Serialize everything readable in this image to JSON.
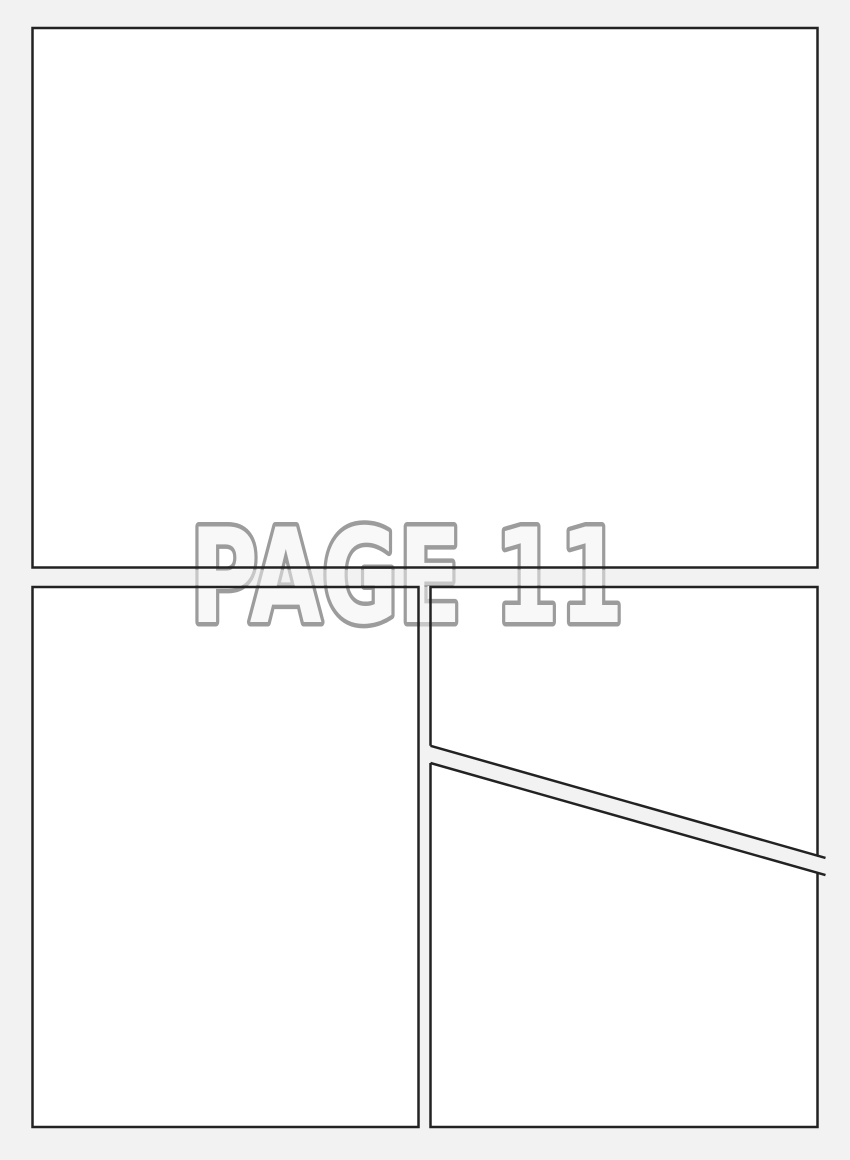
{
  "page": {
    "watermark_label": "PAGE 11"
  },
  "colors": {
    "page_background": "#f2f2f2",
    "panel_fill": "#ffffff",
    "panel_border": "#222222",
    "watermark_fill": "#f8f8f8",
    "watermark_outline": "#9c9c9c"
  },
  "panels": [
    {
      "id": "panel-1",
      "description": "large full-width top panel"
    },
    {
      "id": "panel-2",
      "description": "tall bottom-left panel"
    },
    {
      "id": "panel-3",
      "description": "bottom-right upper panel with diagonal bottom edge"
    },
    {
      "id": "panel-4",
      "description": "bottom-right lower panel with diagonal top edge"
    }
  ]
}
